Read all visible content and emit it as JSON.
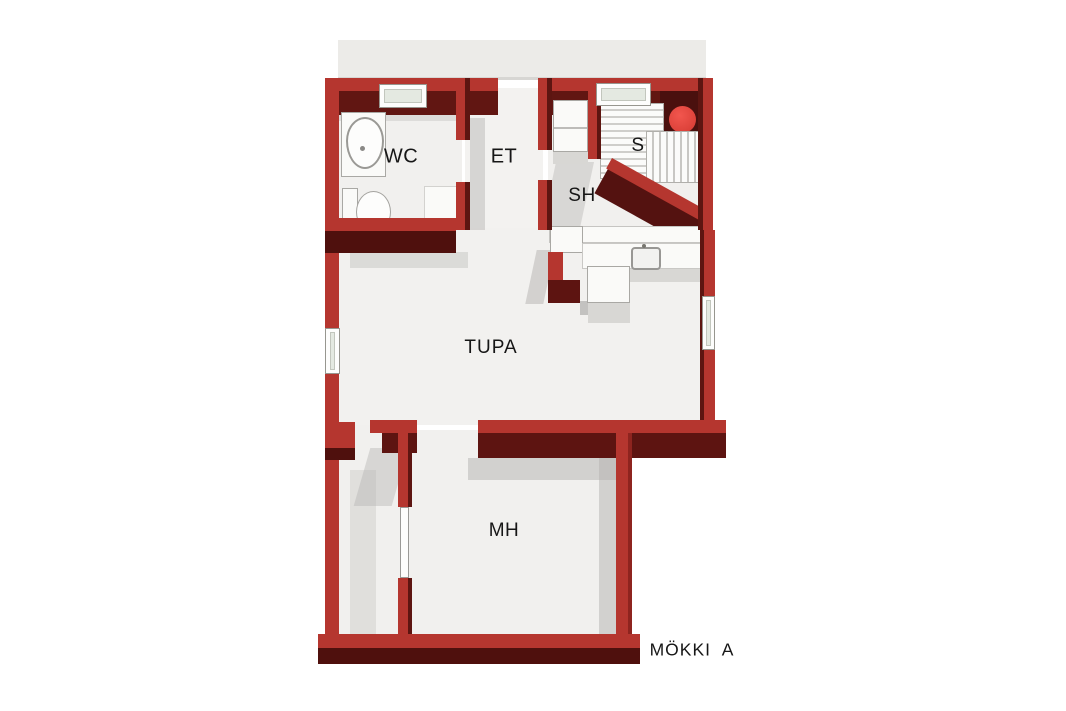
{
  "plan": {
    "title": "MÖKKI  A",
    "rooms": {
      "wc": {
        "label": "WC"
      },
      "et": {
        "label": "ET"
      },
      "s": {
        "label": "S"
      },
      "sh": {
        "label": "SH"
      },
      "tupa": {
        "label": "TUPA"
      },
      "mh": {
        "label": "MH"
      }
    },
    "colors": {
      "wall_top": "#b5362f",
      "wall_inner_face": "#611612",
      "wall_outer_face": "#4f100d",
      "floor": "#f1f0ee",
      "shadow": "#b3b2b0",
      "terrace": "#ecebe8",
      "sauna_stove": "#e8463c",
      "window_frame": "#fdfdfc",
      "window_glass": "#e4e9e1",
      "label_text": "#161616"
    },
    "fixtures": [
      "wc-sink",
      "wc-toilet",
      "wc-cabinet",
      "shower-locker",
      "sauna-bench-upper",
      "sauna-bench-lower",
      "sauna-stove",
      "kitchen-counter",
      "kitchen-sink",
      "kitchen-island",
      "door-leaf"
    ]
  }
}
